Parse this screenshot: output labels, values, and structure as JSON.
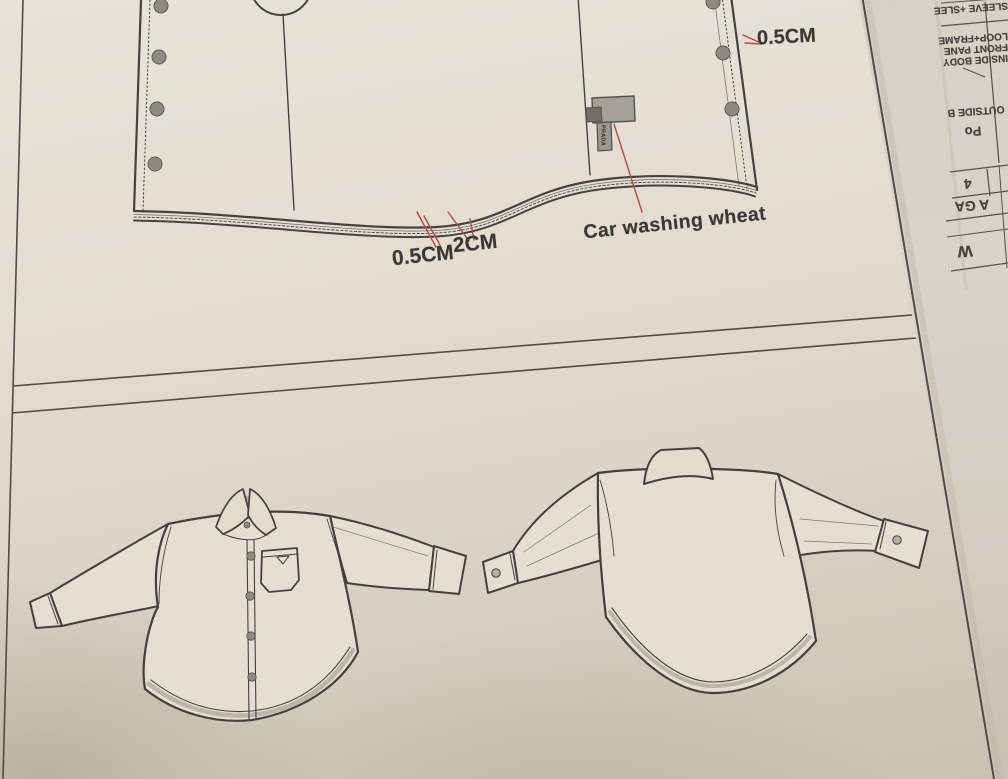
{
  "annotations": {
    "front_edge_stitch": {
      "label": "0.5CM"
    },
    "hem_stitch": {
      "label": "0.5CM"
    },
    "hem_width": {
      "label": "2CM"
    },
    "care_label": {
      "label": "Car washing wheat"
    },
    "tag_text": "PRADA"
  },
  "side_sheet": {
    "rows": [
      {
        "label": "SLEEVE +SLEE"
      },
      {
        "label": "LOOP+FRAME"
      },
      {
        "label": "FRONT PANE"
      },
      {
        "label": "INSIDE BODY"
      },
      {
        "label": "OUTSIDE B"
      },
      {
        "label": "Po"
      },
      {
        "label": "4"
      },
      {
        "label": "A GA"
      },
      {
        "label": "W"
      }
    ]
  },
  "colors": {
    "paper_light": "#e9e3d7",
    "paper_dark": "#cbc3b3",
    "ink": "#46423b",
    "leader_red": "#b14a4c",
    "tag_gray": "#a4a198",
    "button_gray": "#8e8b83"
  }
}
